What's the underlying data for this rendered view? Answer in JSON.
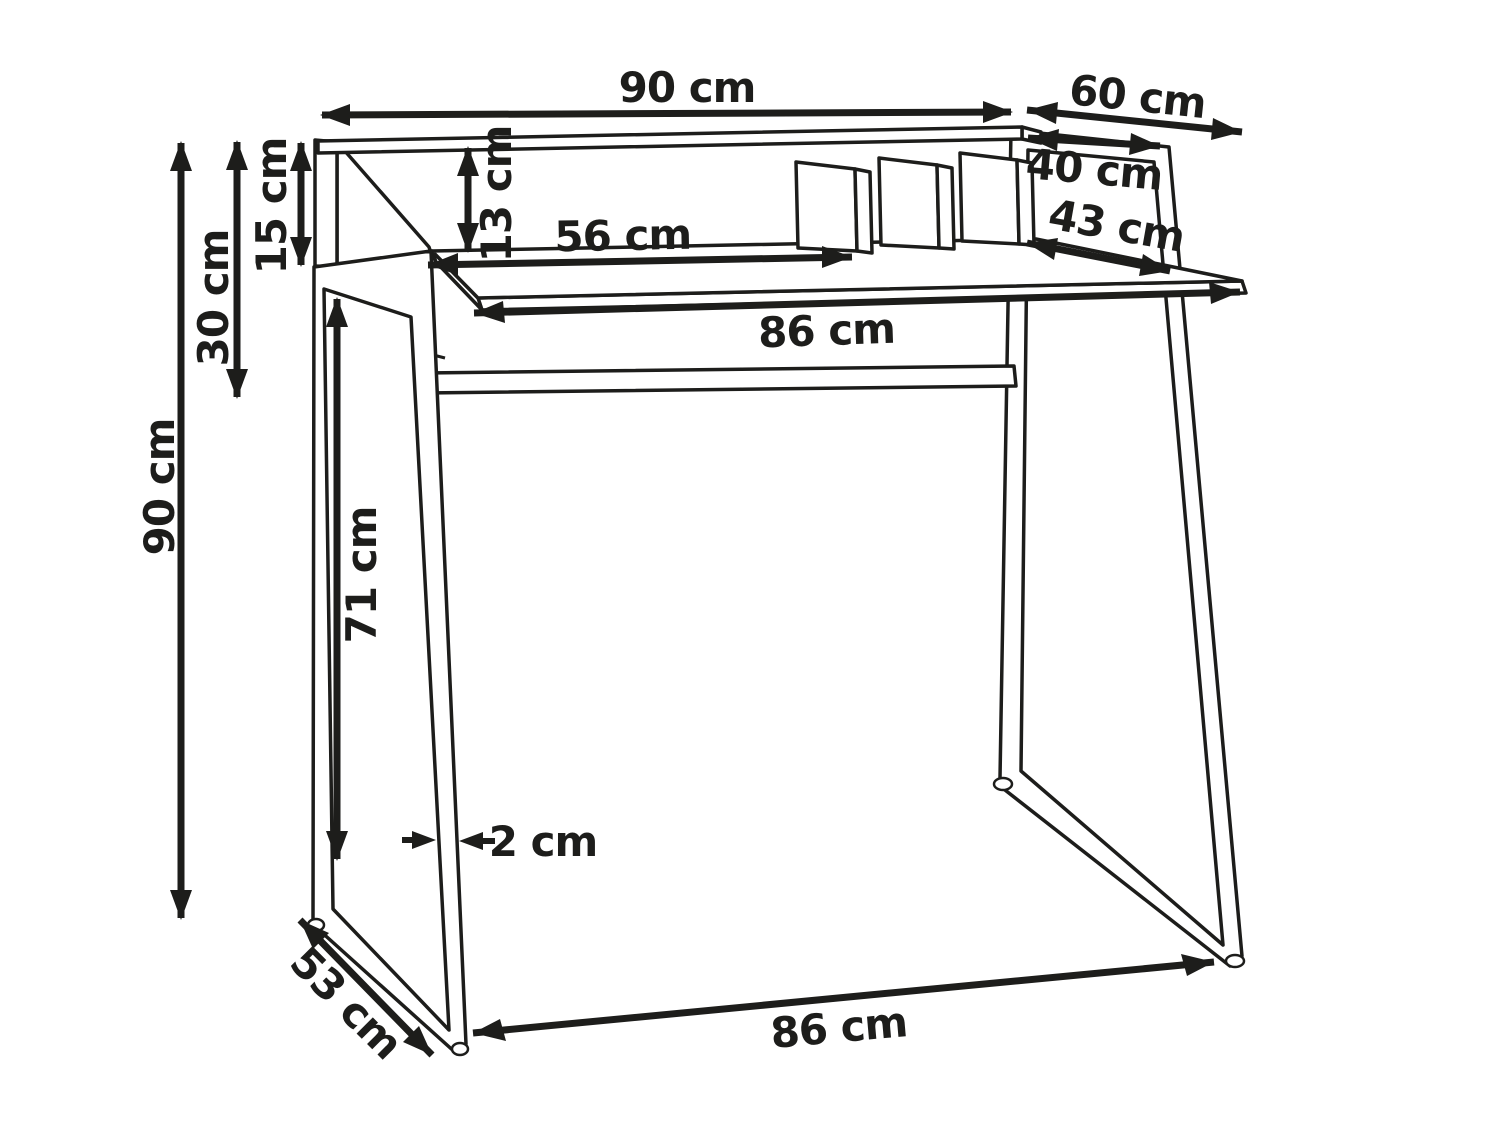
{
  "diagram": {
    "unit": "cm",
    "dimensions": {
      "top_width": {
        "label": "90 cm"
      },
      "depth_total": {
        "label": "60 cm"
      },
      "shelf_depth": {
        "label": "40 cm"
      },
      "desktop_clear_depth": {
        "label": "43 cm"
      },
      "inner_width": {
        "label": "56 cm"
      },
      "divider_height": {
        "label": "13 cm"
      },
      "side_panel_height": {
        "label": "15 cm"
      },
      "back_top_height": {
        "label": "30 cm"
      },
      "total_height": {
        "label": "90 cm"
      },
      "leg_height": {
        "label": "71 cm"
      },
      "frame_thickness": {
        "label": "2 cm"
      },
      "base_depth": {
        "label": "53 cm"
      },
      "desktop_width": {
        "label": "86 cm"
      },
      "base_width": {
        "label": "86 cm"
      }
    }
  }
}
